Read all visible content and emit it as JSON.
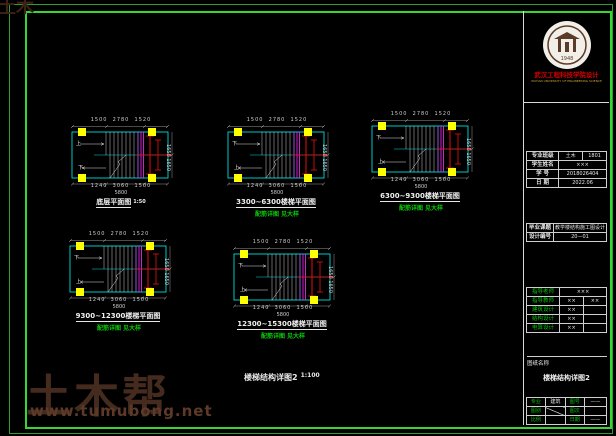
{
  "watermark": {
    "brand": "土木帮",
    "url": "www.tumubong.net",
    "corner": "土木帮"
  },
  "sheet_title": {
    "text": "楼梯结构详图2",
    "scale": "1:100"
  },
  "plans": [
    {
      "label": "底层平面图",
      "scale": "1:50",
      "note": "",
      "dims_top": "1500  2780  1520",
      "dims_bottom": "1240  3060  1500",
      "dim_total": "5800",
      "dims_right": "1650 1650",
      "up": "上",
      "down": "下"
    },
    {
      "label": "3300~6300楼梯平面图",
      "scale": "",
      "note": "配筋详图 见大样",
      "dims_top": "1500  2780  1520",
      "dims_bottom": "1240  3060  1500",
      "dim_total": "5800",
      "dims_right": "1650 1650",
      "up": "下",
      "down": "上"
    },
    {
      "label": "6300~9300楼梯平面图",
      "scale": "",
      "note": "配筋详图 见大样",
      "dims_top": "1500  2780  1520",
      "dims_bottom": "1240  3060  1500",
      "dim_total": "5800",
      "dims_right": "1650 1650",
      "up": "下",
      "down": "上"
    },
    {
      "label": "9300~12300楼梯平面图",
      "scale": "",
      "note": "配筋详图 见大样",
      "dims_top": "1500  2780  1520",
      "dims_bottom": "1240  3060  1500",
      "dim_total": "5800",
      "dims_right": "1650 1650",
      "up": "下",
      "down": "上"
    },
    {
      "label": "12300~15300楼梯平面图",
      "scale": "",
      "note": "配筋详图 见大样",
      "dims_top": "1500  2780  1520",
      "dims_bottom": "1240  3060  1500",
      "dim_total": "5800",
      "dims_right": "1650 1650",
      "up": "下",
      "down": "上"
    }
  ],
  "titleblock": {
    "seal_year": "1948",
    "org_line1": "武汉工程科技学院设计",
    "org_line2": "WUHAN UNIVERSITY OF ENGINEERING SCIENCE",
    "student": {
      "r1": [
        "专业班级",
        "土木",
        "1801"
      ],
      "r2": [
        "学生姓名",
        "×××"
      ],
      "r3": [
        "学 号",
        "2018026404"
      ],
      "r4": [
        "日 期",
        "2022.06"
      ]
    },
    "project": {
      "r1": [
        "毕业课题",
        "教学楼结构施工图设计"
      ],
      "r2": [
        "设计编号",
        "20—01"
      ]
    },
    "signs": [
      [
        "指导老师",
        "×××",
        ""
      ],
      [
        "指导教师",
        "××",
        "××"
      ],
      [
        "建筑设计",
        "××",
        ""
      ],
      [
        "结构设计",
        "××",
        ""
      ],
      [
        "电算设计",
        "××",
        ""
      ]
    ],
    "sheet_label": "图纸名称",
    "sheet_name": "楼梯结构详图2",
    "grid": {
      "r1": [
        "专业",
        "建筑",
        "图号",
        "——"
      ],
      "r2": [
        "图别",
        "",
        "图次",
        ""
      ],
      "r3": [
        "比例",
        "",
        "日期",
        "——"
      ]
    }
  }
}
